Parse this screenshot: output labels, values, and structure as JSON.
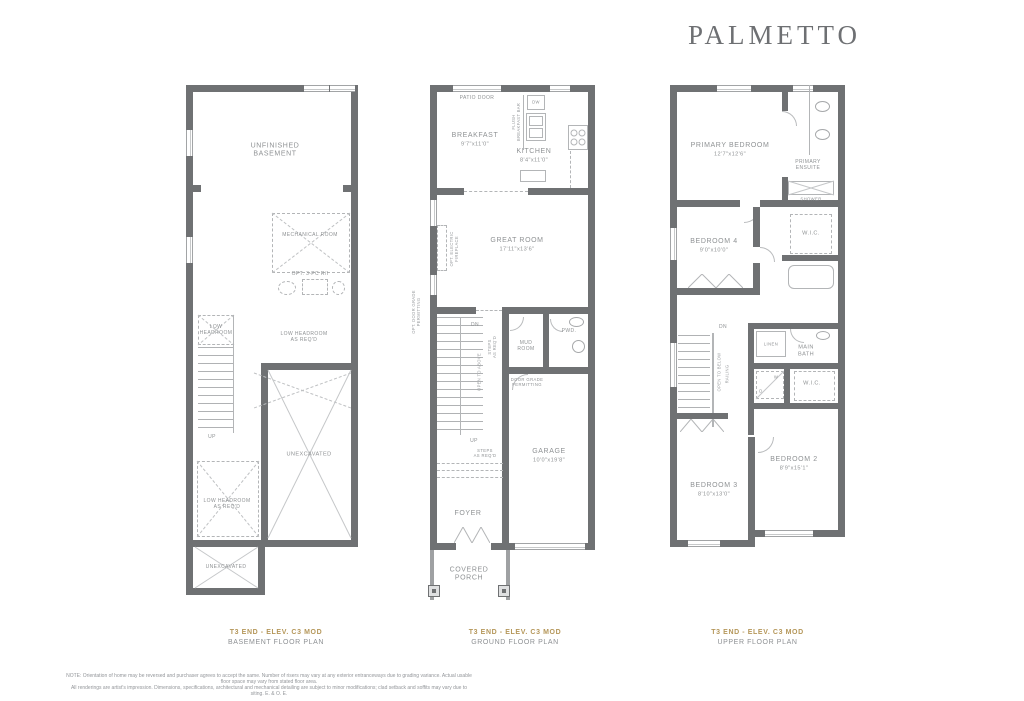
{
  "brand": {
    "logo": "PALMETTO"
  },
  "colors": {
    "wall": "#6f7173",
    "thin_line": "#b3b5b7",
    "label_text": "#8f9294",
    "accent_gold": "#b5975a"
  },
  "basement": {
    "caption": {
      "model": "T3 END - ELEV. C3 MOD",
      "plan": "BASEMENT FLOOR PLAN"
    },
    "labels": {
      "unfinished": "UNFINISHED\nBASEMENT",
      "mechanical": "MECHANICAL ROOM",
      "opt3pc": "OPT. 3-PC R/I",
      "low_headroom": "LOW\nHEADROOM",
      "low_headroom_right": "LOW HEADROOM\nAS REQ'D",
      "low_headroom_bottom": "LOW HEADROOM\nAS REQ'D",
      "up": "UP",
      "unexcavated": "UNEXCAVATED",
      "unexcavated_small": "UNEXCAVATED"
    }
  },
  "ground": {
    "caption": {
      "model": "T3 END - ELEV. C3 MOD",
      "plan": "GROUND FLOOR PLAN"
    },
    "labels": {
      "patio_door": "PATIO DOOR",
      "breakfast": "BREAKFAST",
      "breakfast_dims": "9'7\"x11'0\"",
      "kitchen": "KITCHEN",
      "kitchen_dims": "8'4\"x11'0\"",
      "dw": "DW",
      "flush_bar": "FLUSH\nBREAKFAST BAR",
      "great_room": "GREAT ROOM",
      "great_room_dims": "17'11\"x13'6\"",
      "opt_fireplace": "OPT. ELECTRIC\nFIREPLACE",
      "opt_door_grade": "OPT. DOOR GRADE\nPERMITTING",
      "dn": "DN",
      "up": "UP",
      "open_to_above": "OPEN TO ABOVE",
      "steps_v": "STEPS\nAS REQ'D",
      "mud_room": "MUD\nROOM",
      "pwd": "PWD.",
      "door_grade": "DOOR GRADE\nPERMITTING",
      "steps_h": "STEPS\nAS REQ'D",
      "garage": "GARAGE",
      "garage_dims": "10'0\"x19'8\"",
      "foyer": "FOYER",
      "covered_porch": "COVERED\nPORCH"
    }
  },
  "upper": {
    "caption": {
      "model": "T3 END - ELEV. C3 MOD",
      "plan": "UPPER FLOOR PLAN"
    },
    "labels": {
      "primary": "PRIMARY BEDROOM",
      "primary_dims": "12'7\"x12'6\"",
      "primary_ensuite": "PRIMARY\nENSUITE",
      "shower": "SHOWER",
      "bedroom4": "BEDROOM 4",
      "bedroom4_dims": "9'0\"x10'0\"",
      "wic_top": "W.I.C.",
      "main_bath": "MAIN\nBATH",
      "linen": "LINEN",
      "wic_lower": "W.I.C.",
      "washer": "W",
      "dryer": "D",
      "open_to_below": "OPEN TO BELOW",
      "railing": "RAILING",
      "dn": "DN",
      "bedroom3": "BEDROOM 3",
      "bedroom3_dims": "8'10\"x13'0\"",
      "bedroom2": "BEDROOM 2",
      "bedroom2_dims": "8'9\"x15'1\""
    }
  },
  "note": {
    "text": "NOTE: Orientation of home may be reversed and purchaser agrees to accept the same. Number of risers may vary at any exterior entranceways due to grading variance. Actual usable floor space may vary from stated floor area.\nAll renderings are artist's impression. Dimensions, specifications, architectural and mechanical detailing are subject to minor modifications; clad setback and soffits may vary due to siting. E. & O. E."
  }
}
